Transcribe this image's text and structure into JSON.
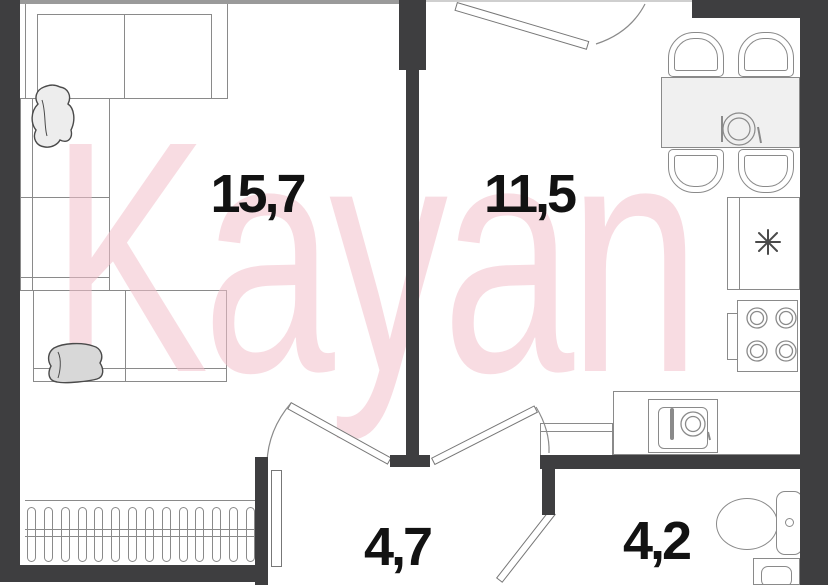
{
  "plan": {
    "type": "floor-plan",
    "watermark": "Kayan",
    "rooms": [
      {
        "name": "living-room",
        "area": "15,7"
      },
      {
        "name": "kitchen",
        "area": "11,5"
      },
      {
        "name": "hallway",
        "area": "4,7"
      },
      {
        "name": "bathroom",
        "area": "4,2"
      }
    ],
    "fixtures": {
      "fridge_icon": "snowflake",
      "stove_burners": 4,
      "dining_chairs": 4,
      "radiator_fins": 14
    },
    "colors": {
      "wall": "#3e3e40",
      "furniture_line": "#8a8a8a",
      "light_fill": "#f0f0f0",
      "watermark_pink": "#f3bfca"
    }
  }
}
